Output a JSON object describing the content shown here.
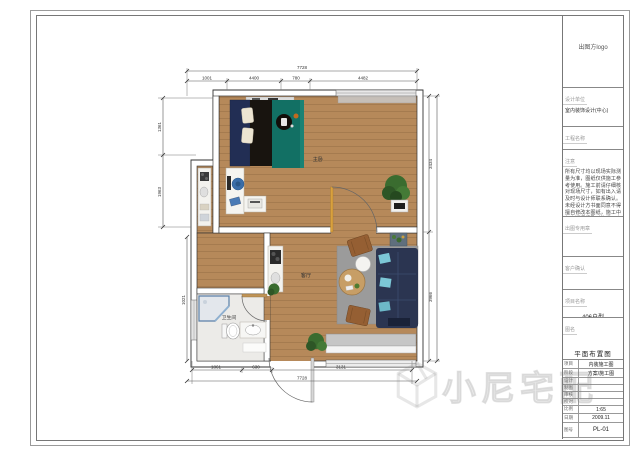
{
  "title_block": {
    "logo_text": "出图方logo",
    "company_label": "设计单位",
    "company_name": "室内装饰设计(中心)",
    "project_heading": "工程名称",
    "notes_label": "注意",
    "notes_text": "所有尺寸均以现场实际测量为准，图纸仅供施工参考使用。施工前请仔细核对现场尺寸，如有出入请及时与设计师联系确认。未经设计方书面同意不得擅自修改本图纸，施工中如有疑问请及时沟通，本图纸版权归设计方所有。",
    "seal_label": "出图专用章",
    "client_label": "客户确认",
    "project_name_label": "项目名称",
    "project_name": "406户型",
    "drawing_title_label": "图名",
    "drawing_title": "平面布置图",
    "rows": [
      {
        "label": "项目",
        "value": "内装施工图"
      },
      {
        "label": "阶段",
        "value": "方案/施工图"
      },
      {
        "label": "设计",
        "value": ""
      },
      {
        "label": "制图",
        "value": ""
      },
      {
        "label": "审核",
        "value": ""
      },
      {
        "label": "校对",
        "value": ""
      },
      {
        "label": "比例",
        "value": "1:65"
      },
      {
        "label": "日期",
        "value": "2009.11"
      },
      {
        "label": "图号",
        "value": "PL-01"
      }
    ]
  },
  "plan": {
    "labels": {
      "bedroom": "主卧",
      "living": "客厅",
      "bathroom": "卫生间"
    }
  },
  "dimensions": {
    "top_total": "7728",
    "top_segments": [
      "1001",
      "4400",
      "780",
      "4482"
    ],
    "left_segments": [
      "1361",
      "1963"
    ],
    "left_lower": "1021",
    "right_segments": [
      "3434",
      "3966"
    ],
    "bottom_segments": [
      "1861",
      "630",
      "3131"
    ],
    "bottom_total": "7728"
  },
  "watermark": {
    "text": "小尼宅配",
    "icon": "cube-logo-icon"
  }
}
